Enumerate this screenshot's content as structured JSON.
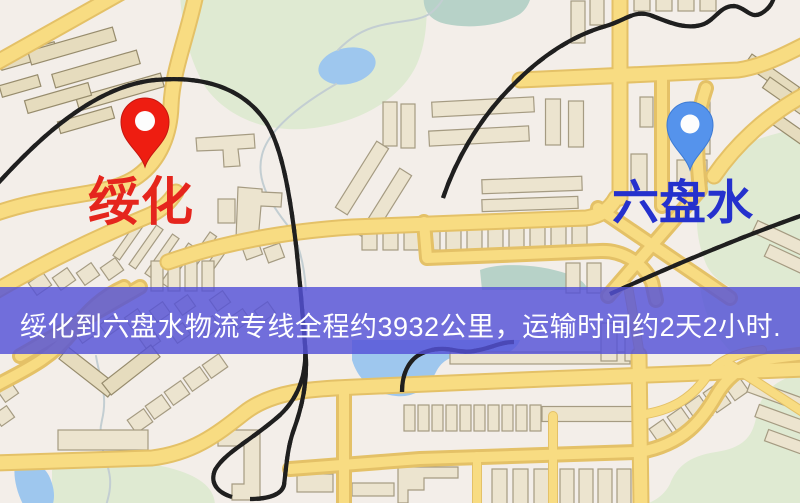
{
  "markers": {
    "origin": {
      "name": "绥化",
      "pin_color": "#ee1d11",
      "label_color": "#e5251d"
    },
    "destination": {
      "name": "六盘水",
      "pin_color": "#5593ec",
      "label_color": "#2531cd"
    }
  },
  "banner": {
    "text": "绥化到六盘水物流专线全程约3932公里，运输时间约2天2小时.",
    "background": "#5452d8",
    "text_color": "#ffffff"
  },
  "route": {
    "from": "绥化",
    "to": "六盘水",
    "distance_km": "3932",
    "duration": "2天2小时"
  },
  "palette": {
    "map_bg": "#f3eee9",
    "road": "#f8dc82",
    "road_casing": "#e4c167",
    "park": "#dfead2",
    "water": "#9ec7ee",
    "building": "#ece4cf",
    "railway": "#1f1f1f"
  }
}
